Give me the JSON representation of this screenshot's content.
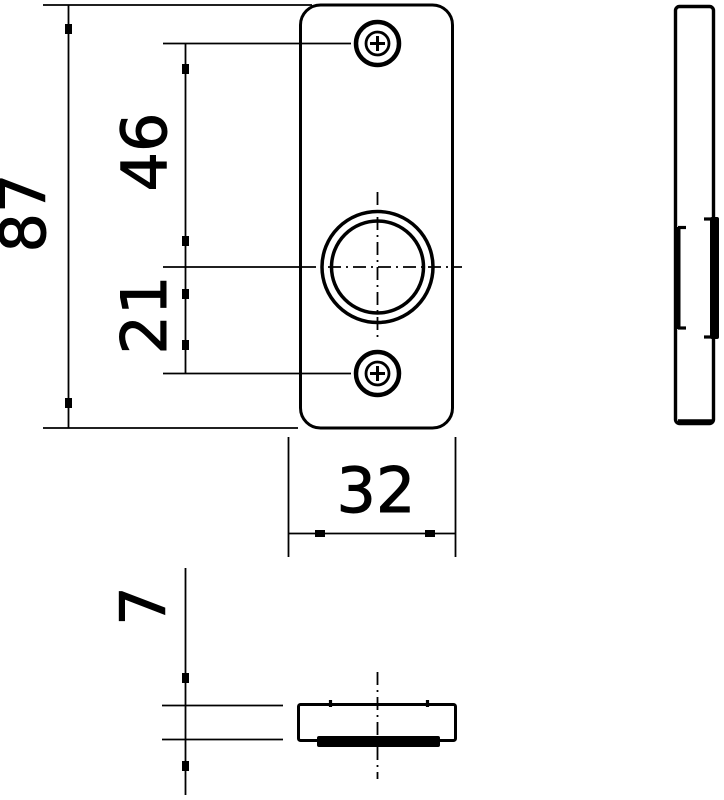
{
  "drawing": {
    "background_color": "#ffffff",
    "line_color": "#000000",
    "dimensions": {
      "plate_height": "87",
      "upper_hole_to_center": "46",
      "center_to_lower_hole": "21",
      "plate_width": "32",
      "plate_thickness": "7"
    }
  }
}
